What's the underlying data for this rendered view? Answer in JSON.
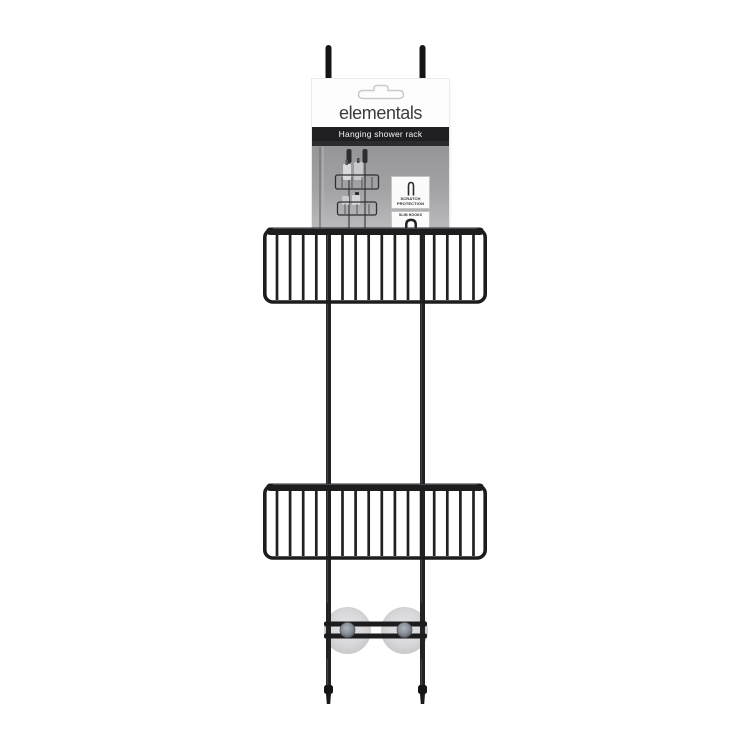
{
  "page": {
    "background_color": "#ffffff"
  },
  "product": {
    "kind": "over-door hanging shower rack, black wire, two baskets",
    "tiers": 2,
    "colors": {
      "rack_black": "#1d1d1f",
      "rail_highlight": "#3e3e42",
      "suction_cup": "#cfcfd1",
      "card_title_bar": "#1f1f21",
      "brand_text": "#3c3c3e"
    },
    "label_card": {
      "brand": "elementals",
      "title_bar": "Hanging shower rack",
      "features": [
        {
          "icon": "scratch-protection-hook-icon",
          "label": "SCRATCH PROTECTION"
        },
        {
          "icon": "slim-hook-icon",
          "label": "SLIM HOOKS"
        }
      ]
    }
  }
}
